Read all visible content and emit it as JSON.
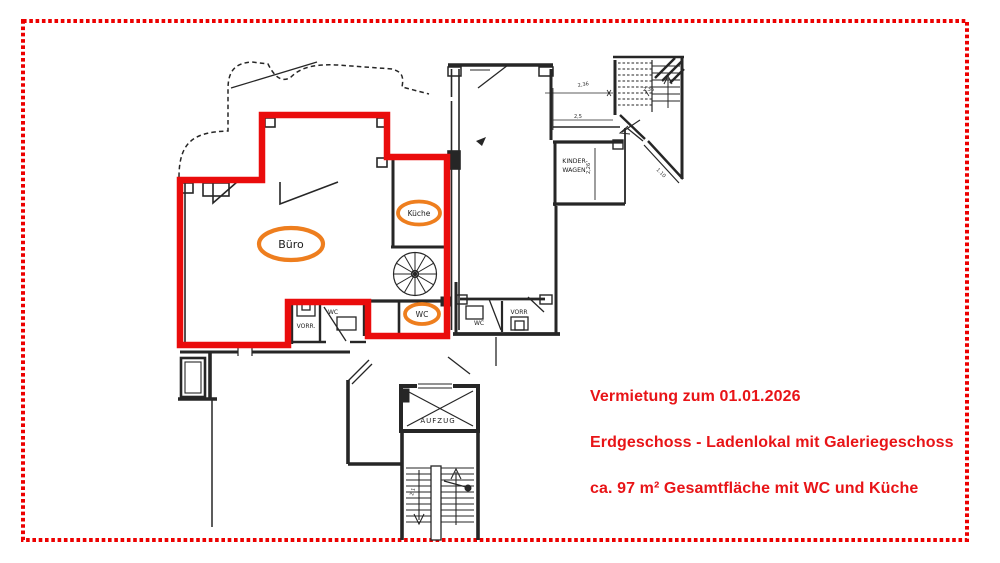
{
  "page": {
    "background": "#ffffff",
    "border_color": "#ec0000"
  },
  "annotations": {
    "color": "#e81417",
    "line1": "Vermietung zum 01.01.2026",
    "line2": "Erdgeschoss - Ladenlokal mit Galeriegeschoss",
    "line3": "ca. 97 m² Gesamtfläche mit WC und Küche"
  },
  "highlight": {
    "unit_outline_color": "#ea0c0c",
    "ellipse_color": "#ee7e1e"
  },
  "rooms": {
    "buero": "Büro",
    "kueche": "Küche",
    "wc_unit": "WC",
    "vorr_left": "VORR.",
    "wc_left": "WC",
    "vorr_right": "VORR",
    "wc_right": "WC",
    "kinderwagen_line1": "KINDER-",
    "kinderwagen_line2": "WAGEN",
    "aufzug": "AUFZUG"
  },
  "dims": {
    "d1": "2,36",
    "d2": "2,36",
    "d3": "2,5",
    "d4": "1.10",
    "d5": "2,26",
    "d6": "2,1"
  }
}
